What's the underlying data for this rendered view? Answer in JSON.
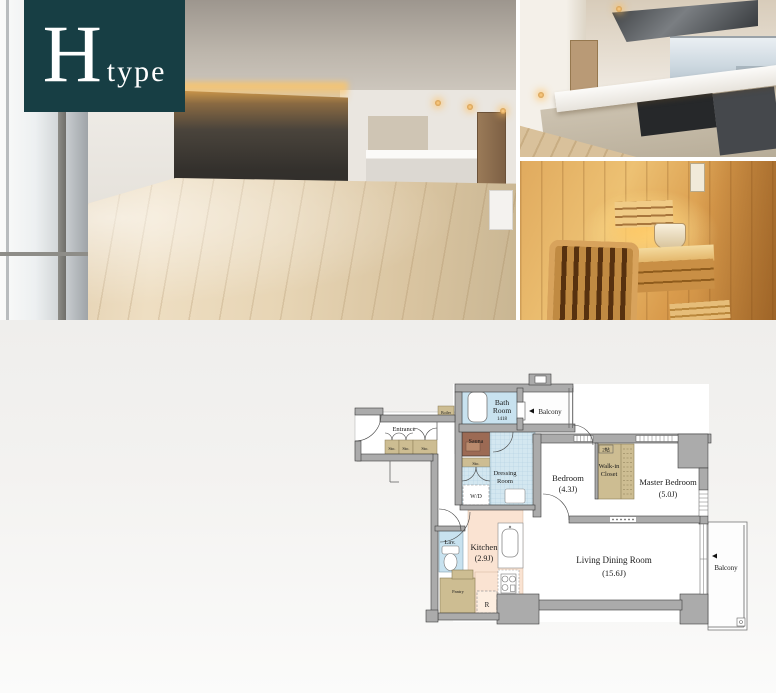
{
  "badge": {
    "letter": "H",
    "suffix": "type",
    "bg_color": "#173e44"
  },
  "floorplan": {
    "rooms": {
      "bath": {
        "name_line1": "Bath",
        "name_line2": "Room",
        "size": "1418"
      },
      "balcony_top": {
        "name": "Balcony"
      },
      "boiler": {
        "name": "Boiler"
      },
      "sauna": {
        "name": "Sauna"
      },
      "sto_sauna": {
        "name": "Sto."
      },
      "entrance": {
        "name": "Entrance"
      },
      "sto_1": {
        "name": "Sto."
      },
      "sto_2": {
        "name": "Sto."
      },
      "sto_3": {
        "name": "Sto."
      },
      "dressing": {
        "name_line1": "Dressing",
        "name_line2": "Room"
      },
      "wd": {
        "name": "W/D"
      },
      "bedroom": {
        "name": "Bedroom",
        "size": "(4.3J)"
      },
      "walk_in_closet": {
        "name_line1": "Walk-in",
        "name_line2": "Closet",
        "size": "2帖"
      },
      "master_bedroom": {
        "name": "Master Bedroom",
        "size": "(5.0J)"
      },
      "lav": {
        "name": "Lav."
      },
      "kitchen": {
        "name": "Kitchen",
        "size": "(2.9J)"
      },
      "pantry": {
        "name": "Pantry"
      },
      "refrigerator": {
        "name": "R"
      },
      "living_dining": {
        "name": "Living Dining Room",
        "size": "(15.6J)"
      },
      "balcony_right": {
        "name": "Balcony"
      }
    },
    "colors": {
      "wall": "#ababab",
      "wall_outline": "#3c3c3c",
      "wet_area_blue": "#cfe5f0",
      "storage_tan": "#cdbd92",
      "sauna_brown": "#9c6a54",
      "kitchen_peach": "#fae3d2",
      "section_background": "#f0efed"
    }
  }
}
